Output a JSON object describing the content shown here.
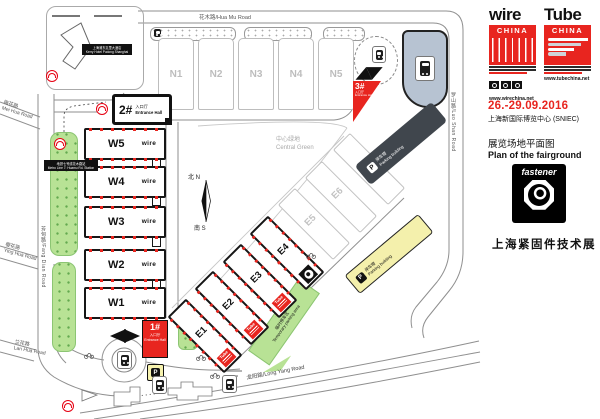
{
  "side": {
    "wire": {
      "word": "wire",
      "china": "CHINA",
      "url": "www.wirechina.net"
    },
    "tube": {
      "word": "Tube",
      "china": "CHINA",
      "url": "www.tubechina.net"
    },
    "date": "26.-29.09.2016",
    "venue": "上海新国际博览中心 (SNIEC)",
    "plan_cn": "展览场地平面图",
    "plan_en": "Plan of the fairground",
    "fastener": {
      "word": "fastener",
      "title": "上海紧固件技术展"
    }
  },
  "map": {
    "roads": {
      "hua_mu": "花木路/Hua Mu Road",
      "luo_shan": "罗山路/Luo Shan Road",
      "fang_dian": "芳甸路/Fang Dian Road",
      "mei_hua_cn": "梅花路",
      "mei_hua_en": "Mei Hua Road",
      "ying_hua_cn": "樱花路",
      "ying_hua_en": "Ying Hua Road",
      "lan_hua_cn": "兰花路",
      "lan_hua_en": "Lan Hua Road",
      "long_yang": "龙阳路/Long Yang Road"
    },
    "kerry": {
      "cn": "上海浦东嘉里大酒店",
      "en": "Kerry Hotel Pudong Shanghai"
    },
    "metro_station": {
      "cn": "地铁七号线花木路站",
      "en": "Metro Line 7: Huamu Rd. Station"
    },
    "central_green": {
      "cn": "中心绿地",
      "en": "Central Green"
    },
    "temp_parking": {
      "cn": "临时停车区",
      "en": "Temporary parking area"
    },
    "parking": {
      "cn": "停车楼",
      "en": "Parking building",
      "p": "P"
    },
    "taxi_p": "P",
    "entrances": {
      "one": {
        "num": "1#",
        "cn": "入口厅",
        "en": "Entrance Hall"
      },
      "two": {
        "num": "2#",
        "cn": "入口厅",
        "en": "Entrance Hall"
      },
      "three": {
        "num": "3#",
        "cn": "入口厅",
        "en": "Entrance Hall"
      }
    },
    "halls": {
      "n": [
        "N1",
        "N2",
        "N3",
        "N4",
        "N5"
      ],
      "w": [
        "W5",
        "W4",
        "W3",
        "W2",
        "W1"
      ],
      "e": [
        "E1",
        "E2",
        "E3",
        "E4"
      ],
      "eg": [
        "E5",
        "E6",
        "E7"
      ]
    },
    "compass": {
      "n": "北 N",
      "s": "南 S"
    },
    "wire_mini": "wire",
    "tube_mini": "Tube"
  }
}
